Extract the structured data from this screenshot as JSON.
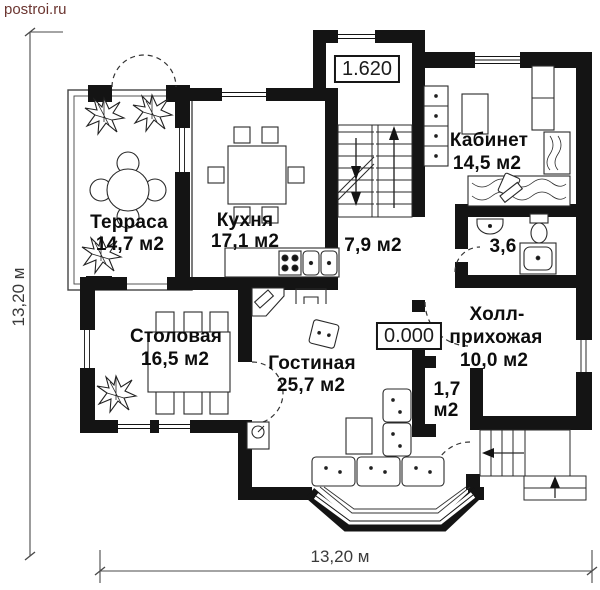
{
  "watermark": "postroi.ru",
  "colors": {
    "wall": "#141414",
    "furniture_line": "#2a2a2a",
    "dimension": "#3a3a3a",
    "watermark": "#6b3530"
  },
  "levels": {
    "first_floor": "1.620",
    "ground": "0.000"
  },
  "dimensions": {
    "left": "13,20 м",
    "bottom": "13,20 м"
  },
  "rooms": {
    "terrace": {
      "name": "Терраса",
      "area": "14,7 м2"
    },
    "kitchen": {
      "name": "Кухня",
      "area": "17,1 м2"
    },
    "stair_hall": {
      "area": "7,9 м2"
    },
    "study": {
      "name": "Кабинет",
      "area": "14,5 м2"
    },
    "bathroom": {
      "area": "3,6"
    },
    "hall": {
      "name_line1": "Холл-",
      "name_line2": "прихожая",
      "area": "10,0 м2"
    },
    "dining": {
      "name": "Столовая",
      "area": "16,5 м2"
    },
    "living": {
      "name": "Гостиная",
      "area": "25,7 м2"
    },
    "closet": {
      "area_value": "1,7",
      "area_unit": "м2"
    }
  }
}
